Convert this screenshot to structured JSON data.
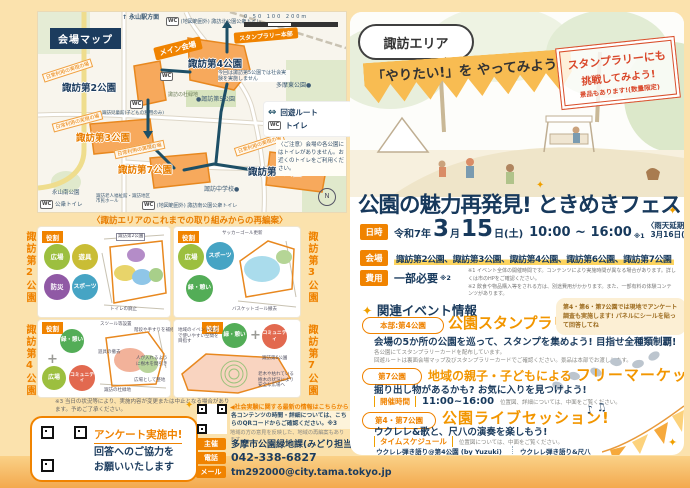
{
  "map": {
    "badge": "会場マップ",
    "station": "永山駅方面",
    "north_toilet": "(地図範囲外) 諏訪北公園公衆トイレ",
    "stamp_hq": "スタンプラリー本部",
    "main_venue": "メイン会場",
    "park2": "諏訪第2公園",
    "park3": "諏訪第3公園",
    "park4": "諏訪第4公園",
    "park6": "諏訪第6公園",
    "park7": "諏訪第7公園",
    "park5": "●諏訪第5公園",
    "tama_east": "多摩東公園●",
    "suwa_mori": "諏訪の杜緑地",
    "no_exp": "今回は諏訪第5公園では社会実験を実施しません",
    "daily": "日常利用の実現の場",
    "jidokan": "諏訪児童館(子どもの利用のみ)",
    "nagayama_minami": "永山南公園",
    "public_toilet": "公衆トイレ",
    "rojin": "諏訪老人福祉館・諏訪地区市民ホール",
    "south_toilet": "(地図範囲外) 諏訪南公園公衆トイレ",
    "junior_high": "諏訪中学校●",
    "wc": "WC",
    "compass_n": "N",
    "arrow_up": "↑",
    "scale0": "0",
    "scale50": "50",
    "scale100": "100",
    "scale200": "200m",
    "legend_route": "回遊ルート",
    "legend_route_icon": "⇔",
    "legend_toilet": "トイレ",
    "caution": "〈ご注意〉会場の各公園にはトイレがありません。お近くのトイレをご利用ください。"
  },
  "reorg": {
    "caption": "〈諏訪エリアのこれまでの取り組みからの再編案〉",
    "role": "役割",
    "plus": "+",
    "p1": {
      "park": "諏訪第2公園",
      "c1": "広場",
      "c2": "遊具",
      "c3": "防災",
      "c4": "スポーツ",
      "n1": "諏訪第2公園",
      "n2": "トイレの廃止"
    },
    "p2": {
      "park": "諏訪第3公園",
      "c1": "広場",
      "c2": "スポーツ",
      "c3": "緑・憩い",
      "n1": "サッカーゴール更新",
      "n2": "バスケットゴール撤去"
    },
    "p3": {
      "park": "諏訪第4公園",
      "c1": "緑・憩い",
      "c2": "広場",
      "c3": "コミュニティ",
      "n1": "スツール等設置",
      "n2": "階段や手すりを補修",
      "n3": "遊具の撤去",
      "n4": "人が入れるように樹木を間引き",
      "n5": "広場として整地",
      "n6": "諏訪の杜緑地"
    },
    "p4": {
      "park": "諏訪第7公園",
      "c1": "緑・憩い",
      "c2": "コミュニティ",
      "n1": "地域のイベントなどで使いやすい空間を目指す",
      "n2": "諏訪第6公園",
      "n3": "老木や枯れている樹木の状況により安全な広場へ"
    },
    "note3": "※3 当日の状況等により、実施内容が変更または中止となる場合があります。予めご了承ください。"
  },
  "survey": {
    "title": "アンケート実施中!",
    "line1": "回答へのご協力を",
    "line2": "お願いいたします"
  },
  "latest": {
    "headline": "◀社会実験に関する最新の情報はこちらから",
    "line1": "各コンテンツの時間・詳細については、こちらのQRコードからご確認ください。※3",
    "line2": "地域の方の意見を反映した、地域の再編案もあります。"
  },
  "contact": {
    "l1": "主催",
    "v1": "多摩市公園緑地課(みどり担当2)",
    "l2": "電話",
    "v2": "042-338-6827",
    "l3": "メール",
    "v3": "tm292000@city.tama.tokyo.jp"
  },
  "hero": {
    "area": "諏訪エリア",
    "banner": "「やりたい!」を やってみよう!",
    "stamp1": "スタンプラリーにも",
    "stamp2": "挑戦してみよう!",
    "stamp3": "景品もあります!(数量限定)",
    "title": "公園の魅力再発見! ときめきフェス",
    "sparkle": "✦"
  },
  "details": {
    "date_label": "日時",
    "era": "令和7年",
    "month": "3",
    "month_u": "月",
    "day": "15",
    "day_u": "日(土)",
    "time": "10:00 ~ 16:00",
    "ref1": "※1",
    "rain1": "〈雨天延期時〉",
    "rain2": "3月16日(日)",
    "venue_label": "会場",
    "venue": "諏訪第2公園、諏訪第3公園、諏訪第4公園、諏訪第6公園、諏訪第7公園",
    "fee_label": "費用",
    "fee": "一部必要",
    "ref2": "※2",
    "note1": "※1 イベント全体の開催時間です。コンテンツにより実施時間が異なる場合があります。詳しくは市のHPをご確認ください。",
    "note2": "※2 飲食や物品購入等をされる方は、別途費用がかかります。また、一部有料の体験コンテンツがあります。"
  },
  "events": {
    "header": "関連イベント情報",
    "e1": {
      "badge": "本部:第4公園",
      "title": "公園スタンプラリー in 諏訪エリア",
      "sub": "会場の5か所の公園を巡って、スタンプを集めよう!  目指せ全種類制覇!",
      "small1": "各公園にてスタンプラリーカードを配布しています。",
      "small2": "回遊ルートは裏面会場マップ及びスタンプラリーカードでご確認ください。景品は本部でお渡しします。",
      "bubble1": "第4・第6・第7公園では現地でアンケート調査も実施します!",
      "bubble2": "パネルにシールを貼って回答してね"
    },
    "e2": {
      "badge": "第7公園",
      "title1": "地域の親子・子どもによる",
      "title2": "フリーマーケット",
      "sub": "掘り出し物があるかも?  お気に入りを見つけよう!",
      "time_label": "開催時間",
      "time": "11:00~16:00",
      "small": "位置図、詳細については、中面をご覧ください。"
    },
    "e3": {
      "badge": "第4・第7公園",
      "title": "公園ライブセッション!",
      "sub": "ウクレレ&歌と、尺八の演奏を楽しもう!",
      "time_label": "タイムスケジュール",
      "small": "位置図については、中面をご覧ください。",
      "notes_icon": "♪ ♫",
      "s1name": "ウクレレ弾き語り@第4公園 (by Yuzuki)",
      "s1time": "12:45~ / 14:45~",
      "s2name1": "ウクレレ弾き語り&尺八",
      "s2name2": "@第7公園 (by 風とキャラバン)",
      "s2time": "11:30~ / 14:00~"
    }
  }
}
